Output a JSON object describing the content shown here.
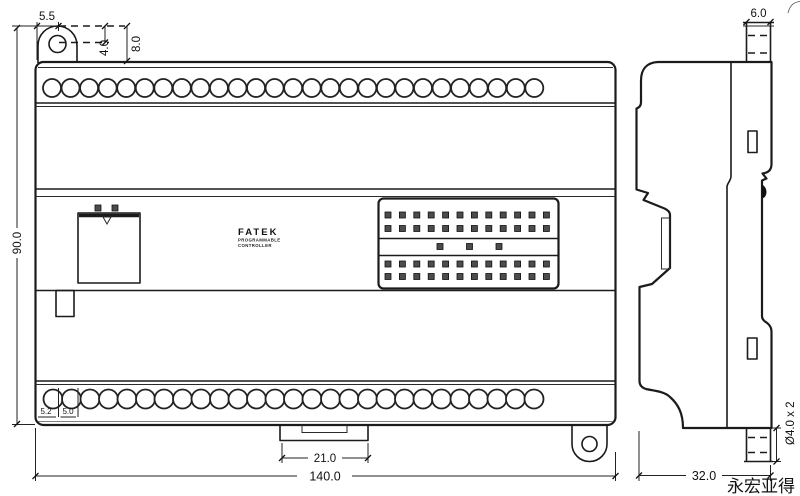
{
  "page": {
    "background": "#ffffff",
    "ink": "#1b1b1b"
  },
  "front_view": {
    "logo": {
      "brand": "FATEK",
      "sub1": "PROGRAMMABLE",
      "sub2": "CONTROLLER"
    },
    "dimensions": {
      "ear_center_offset": "5.5",
      "hole_center_drop": "4.0",
      "body_top_drop": "8.0",
      "overall_height": "90.0",
      "first_hole_offset": "5.2",
      "hole_pitch": "5.0",
      "din_clip_width": "21.0",
      "overall_width": "140.0"
    },
    "terminal_screws": {
      "top_count": 27,
      "bottom_count": 27
    },
    "io_connector": {
      "pin_rows": 4,
      "pins_per_row": 12,
      "middle_pins": 3
    }
  },
  "side_view": {
    "dimensions": {
      "mount_post_width": "6.0",
      "mount_hole_spec": "Ø4.0 x 2",
      "overall_depth": "32.0"
    }
  },
  "watermark": "永宏亚得"
}
